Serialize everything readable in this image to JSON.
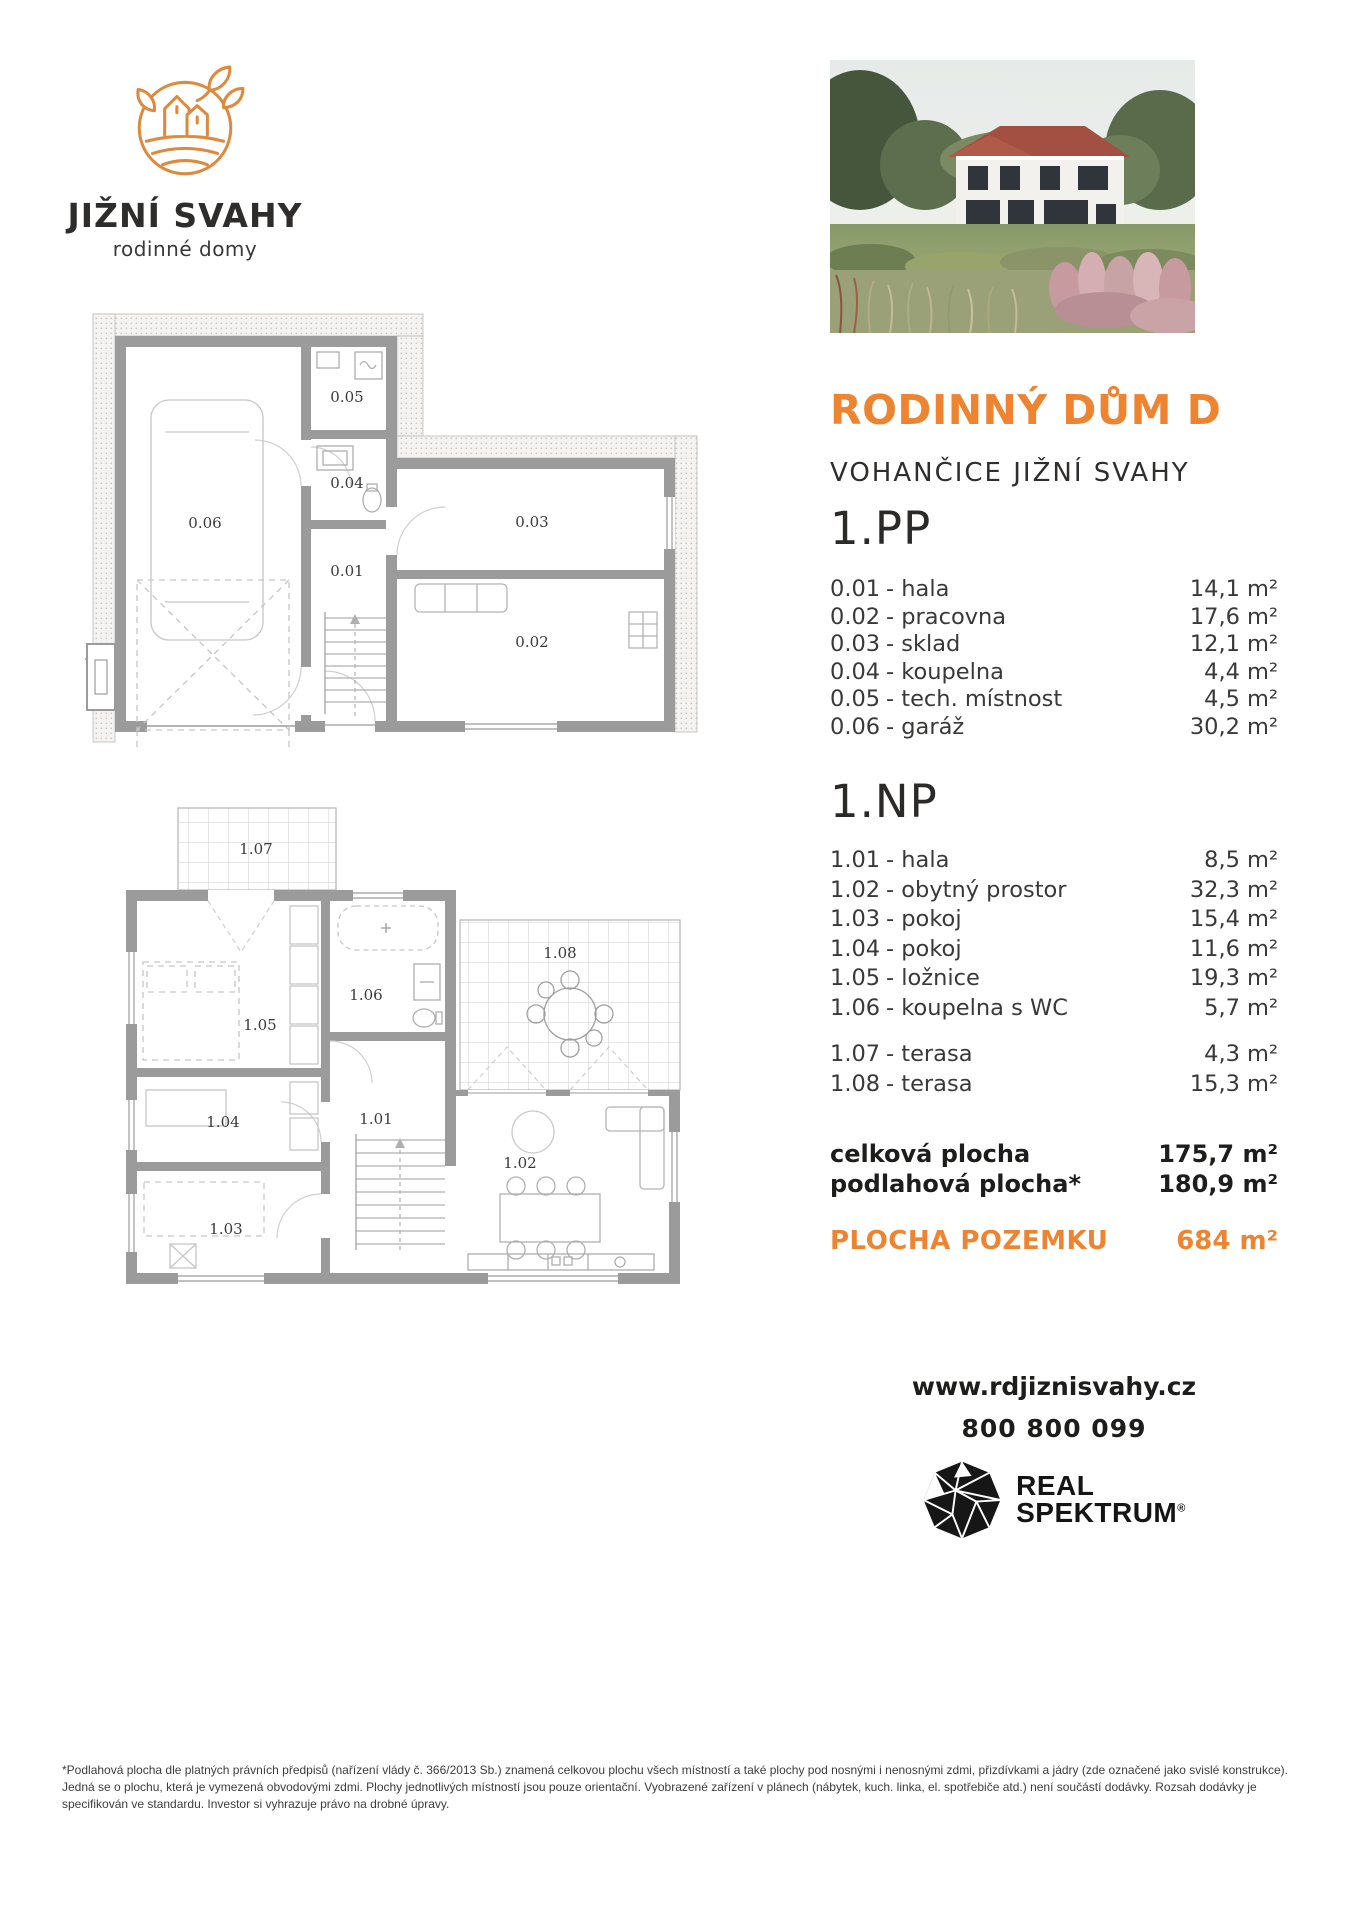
{
  "brand": {
    "name": "JIŽNÍ SVAHY",
    "tagline": "rodinné domy"
  },
  "header": {
    "title": "RODINNÝ DŮM D",
    "subtitle": "VOHANČICE JIŽNÍ SVAHY"
  },
  "floor_pp": {
    "heading": "1.PP",
    "rooms": [
      {
        "code": "0.01",
        "name": "- hala",
        "area": "14,1 m²"
      },
      {
        "code": "0.02",
        "name": "- pracovna",
        "area": "17,6 m²"
      },
      {
        "code": "0.03",
        "name": "- sklad",
        "area": "12,1 m²"
      },
      {
        "code": "0.04",
        "name": "- koupelna",
        "area": "4,4 m²"
      },
      {
        "code": "0.05",
        "name": "- tech. místnost",
        "area": "4,5 m²"
      },
      {
        "code": "0.06",
        "name": "- garáž",
        "area": "30,2 m²"
      }
    ]
  },
  "floor_np": {
    "heading": "1.NP",
    "rooms": [
      {
        "code": "1.01",
        "name": "- hala",
        "area": "8,5 m²"
      },
      {
        "code": "1.02",
        "name": "- obytný prostor",
        "area": "32,3 m²"
      },
      {
        "code": "1.03",
        "name": "- pokoj",
        "area": "15,4 m²"
      },
      {
        "code": "1.04",
        "name": "- pokoj",
        "area": "11,6 m²"
      },
      {
        "code": "1.05",
        "name": "- ložnice",
        "area": "19,3 m²"
      },
      {
        "code": "1.06",
        "name": "- koupelna s WC",
        "area": "5,7 m²"
      }
    ],
    "terraces": [
      {
        "code": "1.07",
        "name": "- terasa",
        "area": "4,3 m²"
      },
      {
        "code": "1.08",
        "name": "- terasa",
        "area": "15,3 m²"
      }
    ]
  },
  "totals": {
    "total_label": "celková plocha",
    "total_value": "175,7 m²",
    "floor_label": "podlahová plocha*",
    "floor_value": "180,9 m²",
    "land_label": "PLOCHA POZEMKU",
    "land_value": "684 m²"
  },
  "contact": {
    "website": "www.rdjiznisvahy.cz",
    "phone": "800 800 099"
  },
  "agency": {
    "name_line1": "REAL",
    "name_line2": "SPEKTRUM",
    "reg_mark": "®"
  },
  "plan_pp": {
    "labels": {
      "r01": "0.01",
      "r02": "0.02",
      "r03": "0.03",
      "r04": "0.04",
      "r05": "0.05",
      "r06": "0.06"
    }
  },
  "plan_np": {
    "labels": {
      "r01": "1.01",
      "r02": "1.02",
      "r03": "1.03",
      "r04": "1.04",
      "r05": "1.05",
      "r06": "1.06",
      "r07": "1.07",
      "r08": "1.08"
    }
  },
  "colors": {
    "accent": "#EE8330",
    "logo_orange": "#DE8A3E",
    "text_dark": "#2F2E2D",
    "wall_gray": "#9B9B9B"
  },
  "footnote": "*Podlahová plocha dle platných právních předpisů (nařízení vlády č. 366/2013 Sb.) znamená celkovou plochu všech místností a také plochy pod nosnými i nenosnými zdmi, přizdívkami a jádry (zde označené jako svislé konstrukce). Jedná se o plochu, která je vymezená obvodovými zdmi. Plochy jednotlivých místností jsou pouze orientační. Vyobrazené zařízení v plánech (nábytek, kuch. linka, el. spotřebiče atd.) není součástí dodávky. Rozsah dodávky je specifikován ve standardu. Investor si vyhrazuje právo na drobné úpravy."
}
